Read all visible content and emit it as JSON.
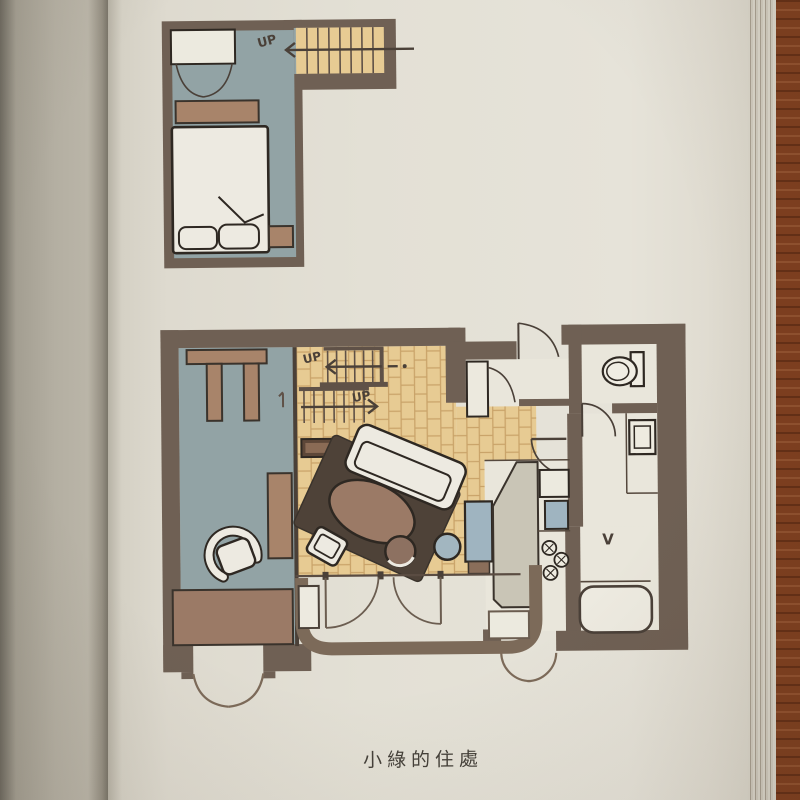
{
  "page": {
    "caption": "小綠的住處"
  },
  "upper_plan": {
    "stair_label": "UP"
  },
  "main_plan": {
    "stair_to_loft_label": "UP",
    "stair_entry_label": "UP",
    "vanity_mark": "V"
  },
  "colors": {
    "table_wood": "#7e3f1f",
    "left_page": "#b4afa2",
    "right_page": "#e3e0d5",
    "wall": "#6f6054",
    "blue_floor": "#92a3a5",
    "wood_floor": "#e7cb93",
    "parquet_line": "#bf955a",
    "rug": "#4e4238",
    "furniture_brown": "#a8846a",
    "dark_cabinet": "#5d4738",
    "counter_gray": "#c9c5b6",
    "accent_blue": "#9fb4c0",
    "white_fixture": "#edeae1",
    "ink": "#4a4038"
  }
}
